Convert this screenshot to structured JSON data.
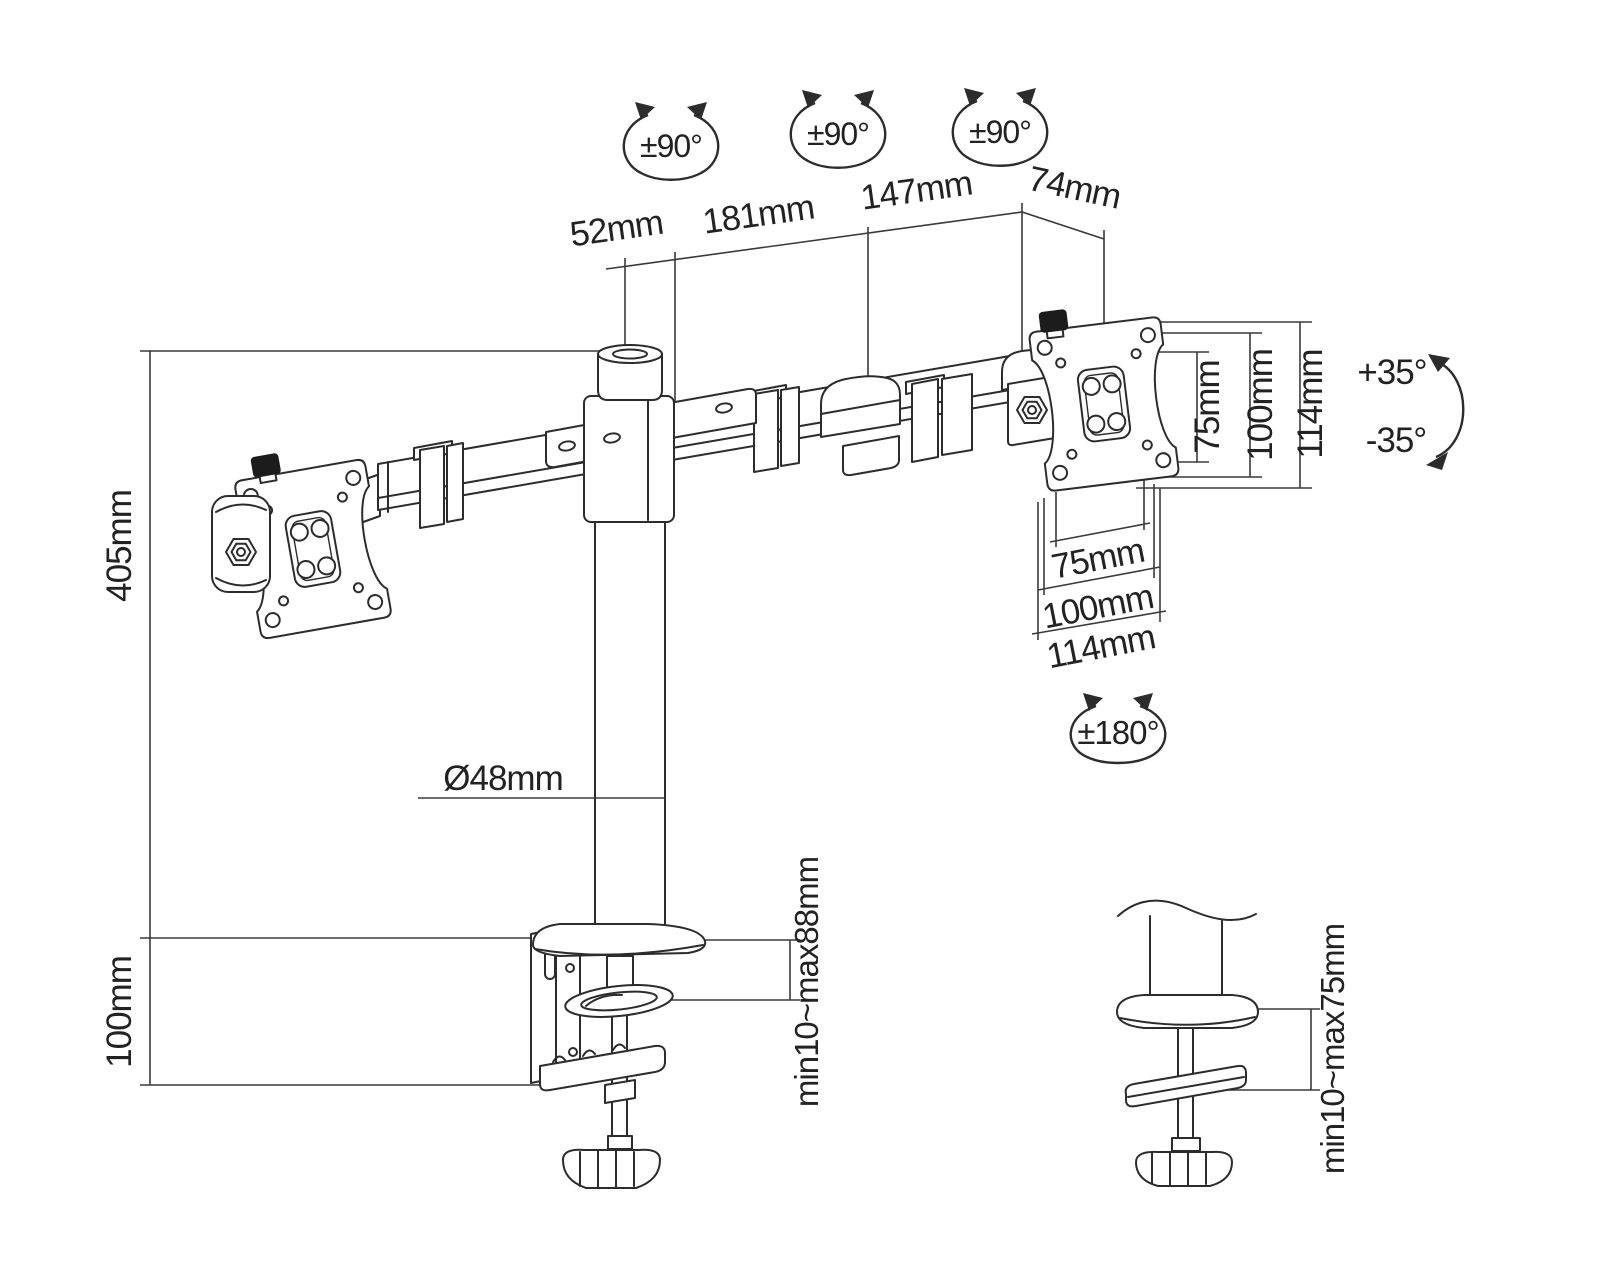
{
  "diagram": {
    "kind": "monitor-arm dimensional line drawing",
    "background": "#ffffff",
    "line_color": "#2c2c2c",
    "rotation_badges": {
      "swivel_left": "±90°",
      "swivel_middle": "±90°",
      "swivel_right": "±90°",
      "pan": "±180°",
      "tilt_up": "+35°",
      "tilt_down": "-35°"
    },
    "horizontal_dims": {
      "pole_cap": "52mm",
      "arm_segment_inner": "181mm",
      "arm_segment_outer": "147mm",
      "head_offset": "74mm"
    },
    "vertical_dims": {
      "pole_height": "405mm",
      "base_height": "100mm"
    },
    "pole_diameter": "Ø48mm",
    "vesa_vertical": {
      "inner": "75mm",
      "mid": "100mm",
      "outer": "114mm"
    },
    "vesa_horizontal": {
      "inner": "75mm",
      "mid": "100mm",
      "outer": "114mm"
    },
    "desk_thickness": {
      "clamp_range": "min10~max88mm",
      "grommet_range": "min10~max75mm"
    }
  }
}
